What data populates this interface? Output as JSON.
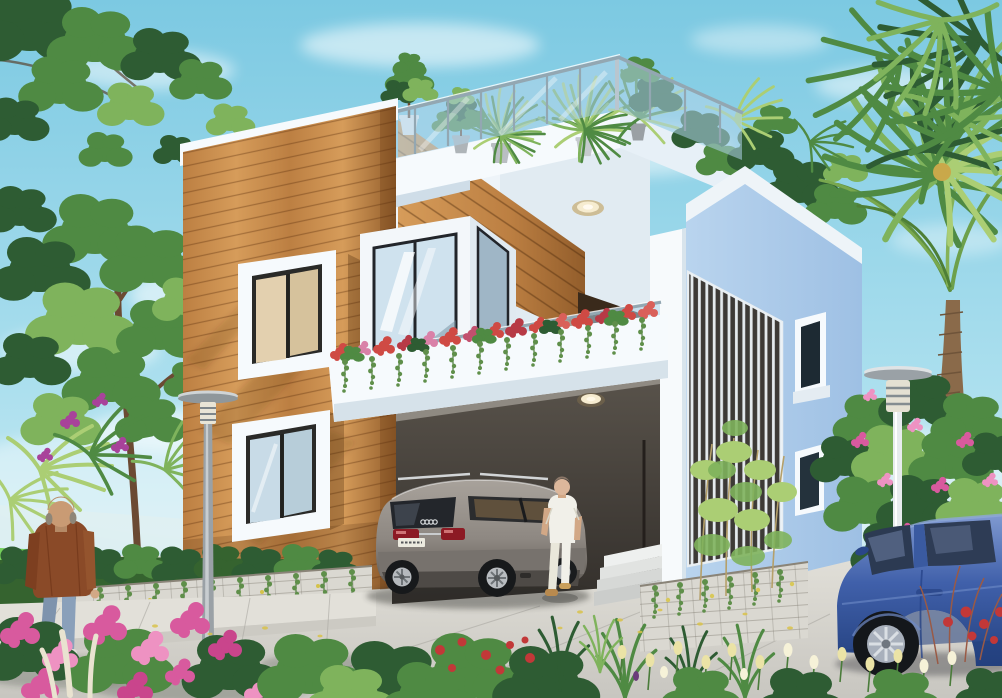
{
  "meta": {
    "title": "Modern duplex house exterior - 3D architectural rendering",
    "canvas": {
      "width": 1002,
      "height": 698
    },
    "description": "Photorealistic daytime exterior rendering of a modern two-storey house with an orange wood-slat facade and white volumes, rooftop terrace with glass railing and potted plants, flower-filled balcony planter, recessed carport with a grey SUV, a woman in white walking toward the entry, a bald man in a brown jacket walking on the left sidewalk, garden lamp posts, stone planter walls with trailing vines, tropical trees and palms, pink bougainvillea and frangipani, yellow tulips, and a blue sedan in the right foreground under a light blue sky with soft clouds."
  },
  "scene": {
    "objects": [
      "sky",
      "clouds",
      "left-trees",
      "lawn-strip",
      "wooden-facade",
      "facade-parapet-cap",
      "upper-left-window",
      "lower-left-window",
      "roof-terrace",
      "terrace-glass-railing",
      "terrace-potted-plants",
      "bay-window",
      "balcony-planter",
      "balcony-flowers",
      "balcony-glass-railing",
      "balcony-ceiling-light",
      "balcony-door",
      "wood-side-wall",
      "right-white-volume",
      "louver-screen-panel",
      "side-window-upper",
      "side-window-lower",
      "entry-pillar",
      "carport",
      "carport-ceiling-light",
      "entry-steps",
      "suv-car",
      "license-plate (text illegible)",
      "woman-figure",
      "man-figure",
      "lamp-post-left",
      "lamp-post-right",
      "hedge-row",
      "planter-wall-left",
      "planter-wall-right",
      "bamboo-trees",
      "palm-tree-right",
      "plumeria-bush",
      "blue-sedan",
      "bougainvillea-left",
      "pampas-plumes",
      "red-roses",
      "grass-tufts",
      "tulip-bed",
      "sidewalk",
      "driveway",
      "fallen-petals"
    ],
    "license_plate_text": "",
    "people_count": 2,
    "vehicle_count": 2
  },
  "colors": {
    "sky-top": "#7cc9e2",
    "sky-mid": "#abdfee",
    "sky-horizon": "#e2f3f6",
    "cloud": "#ffffff",
    "wood-light": "#d69c5a",
    "wood-mid": "#bc7f42",
    "wood-dark": "#925d2b",
    "wood-line": "rgba(92,48,12,0.38)",
    "wall-white": "#f6fafd",
    "wall-shade": "#d9e6f0",
    "wall-blue": "#a9c8e8",
    "wall-blue-light": "#c6dbf1",
    "glass": "rgba(176,212,234,0.55)",
    "rail-metal": "#93a7b2",
    "carport-dark": "#332f2b",
    "carport-mid": "#5a544c",
    "door-brown": "#3a2a1b",
    "suv-body": "#8e8882",
    "suv-roof": "#a8a29b",
    "suv-lower": "#5f5a55",
    "tail-red": "#8c1a24",
    "plate-white": "#eceadf",
    "sedan-blue": "#4060aa",
    "sedan-roof": "#7f99d0",
    "sedan-dark": "#24417f",
    "stone": "#dad8d1",
    "stone-shade": "#bfbdb6",
    "pave": "#c8c6c0",
    "pave-light": "#e1dfd8",
    "leaf-dark": "#2e5c33",
    "leaf-mid": "#4f8a43",
    "leaf-light": "#7fb35c",
    "leaf-pale": "#abce74",
    "hedge-green": "#35632f",
    "trunk-brown": "#6b4a33",
    "palm-trunk": "#8a6a4a",
    "pink-flower": "#d85a9e",
    "pink-light": "#ee92c2",
    "red-flower": "#c23838",
    "balcony-flower": "#cf4a44",
    "tulip-yellow": "#ebe3a6",
    "vine-green": "#5f8f4a",
    "skin": "#d2a886",
    "jacket-brown": "#8a4a28",
    "jeans-blue": "#7e93ad",
    "outfit-white": "#f1f0e9",
    "lamp-gray": "#9aa1a6",
    "light-warm": "#f6ecd0"
  }
}
